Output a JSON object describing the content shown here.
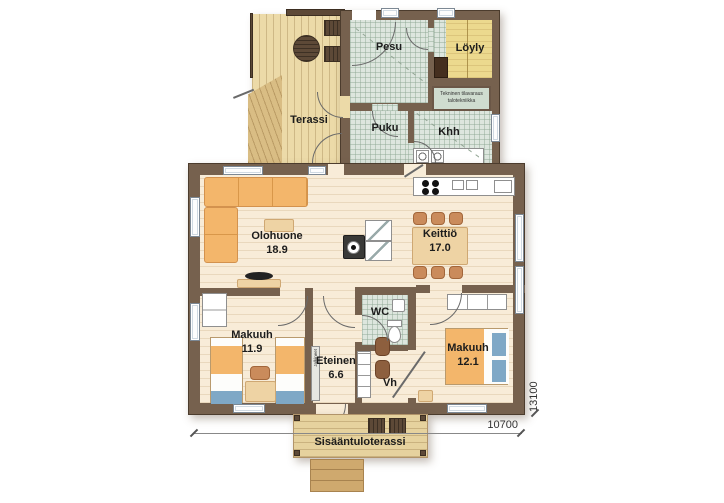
{
  "rooms": {
    "pesu": {
      "name": "Pesu"
    },
    "loyly": {
      "name": "Löyly"
    },
    "tekninen": {
      "line1": "Tekninen tilavaraus",
      "line2": "talotekniikka"
    },
    "terassi": {
      "name": "Terassi"
    },
    "puku": {
      "name": "Puku"
    },
    "khh": {
      "name": "Khh"
    },
    "olohuone": {
      "name": "Olohuone",
      "area": "18.9"
    },
    "keittio": {
      "name": "Keittiö",
      "area": "17.0"
    },
    "makuuhuone_1": {
      "name": "Makuuh",
      "area": "11.9"
    },
    "eteinen": {
      "name": "Eteinen",
      "area": "6.6"
    },
    "wc": {
      "name": "WC"
    },
    "vh": {
      "name": "Vh"
    },
    "makuuhuone_2": {
      "name": "Makuuh",
      "area": "12.1"
    },
    "sisaantuloterassi": {
      "name": "Sisääntuloterassi"
    }
  },
  "fixtures": {
    "shoe_rack_label": "Jalkineet"
  },
  "dimensions": {
    "width": "10700",
    "depth": "13100"
  },
  "colors": {
    "wall": "#76614e",
    "floor": "#f8ecd8",
    "tile": "#dde6de",
    "sauna_bench": "#ecd98e",
    "deck": "#ecdaa8",
    "furniture_orange": "#f3b66b",
    "textile_blue": "#7fa8c6",
    "dark_wood": "#5d4937"
  }
}
